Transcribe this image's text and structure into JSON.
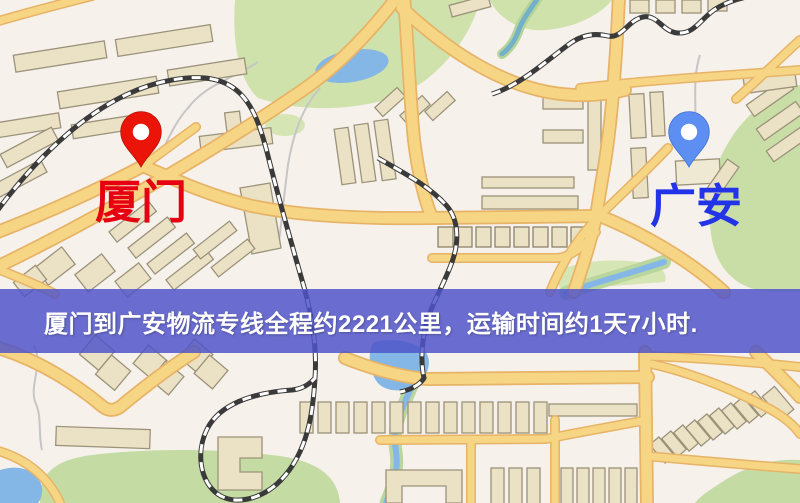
{
  "banner": {
    "text": "厦门到广安物流专线全程约2221公里，运输时间约1天7小时.",
    "background": "rgba(79,83,201,0.84)",
    "text_color": "#ffffff"
  },
  "markers": [
    {
      "id": "origin",
      "label": "厦门",
      "pin_color": "#ea1508",
      "label_color": "#e60012"
    },
    {
      "id": "destination",
      "label": "广安",
      "pin_color": "#5d8ef2",
      "label_color": "#2334e8"
    }
  ],
  "route": {
    "distance_text": "约2221公里",
    "duration_text": "约1天7小时"
  },
  "map_colors": {
    "background": "#f7f1ec",
    "road": "#f6d685",
    "road_casing": "#e7b366",
    "park": "#cfe2ab",
    "water": "#85b7e6",
    "building": "#ebe2c6",
    "railway": "#3a3a3a"
  }
}
